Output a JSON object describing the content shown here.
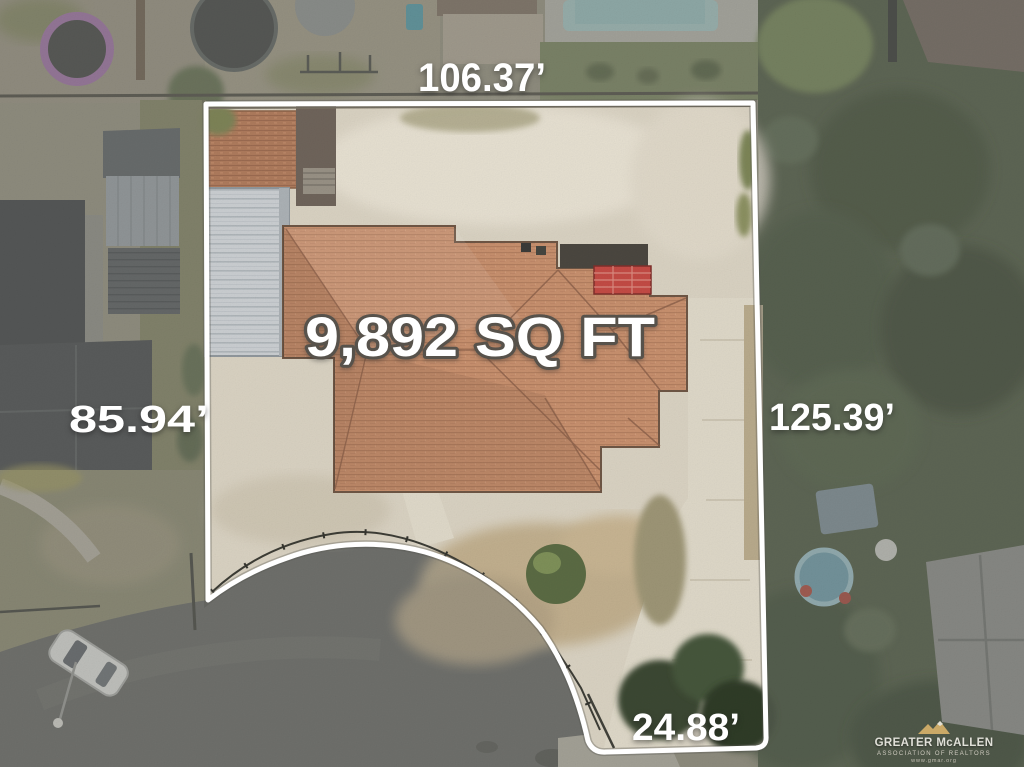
{
  "page": {
    "type": "aerial-property-lot-photo",
    "width": 1024,
    "height": 767
  },
  "property": {
    "area_label": "9,892 SQ FT",
    "boundary_measurements": {
      "top": "106.37’",
      "left": "85.94’",
      "right": "125.39’",
      "bottom": "24.88’"
    }
  },
  "watermark": {
    "logo": "mountain-logo",
    "name": "GREATER McALLEN",
    "subtitle": "ASSOCIATION OF REALTORS",
    "tagline": "www.gmar.org"
  },
  "colors": {
    "boundary_line": "#ffffff",
    "label_text": "#ffffff",
    "area_label_outline": "#57524b",
    "roof_terracotta": "#c28a69",
    "lot_concrete": "#d8d1c1",
    "street_asphalt": "#646461",
    "trees_dark_green": "#49543c",
    "pool_teal": "#a3c6c3",
    "trampoline_purple": "#9f6fa5",
    "metal_roof_gray": "#c9cdd0",
    "watermark_gold": "#d9b36b"
  }
}
